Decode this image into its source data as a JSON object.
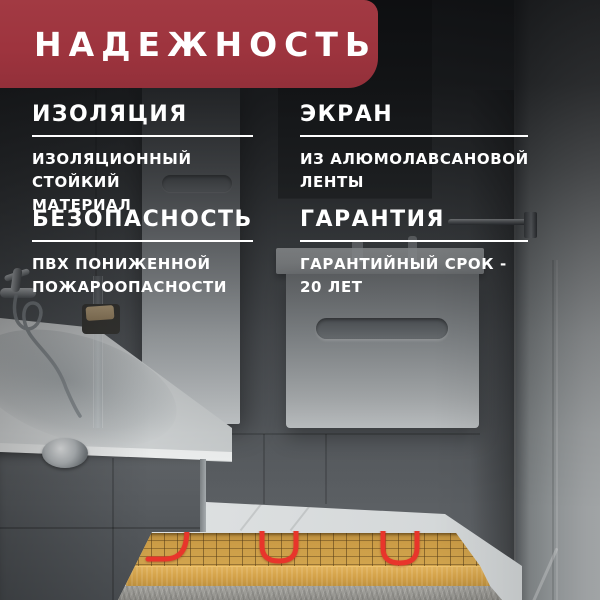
{
  "banner": {
    "title": "НАДЕЖНОСТЬ"
  },
  "features": [
    {
      "heading": "ИЗОЛЯЦИЯ",
      "description": "ИЗОЛЯЦИОННЫЙ СТОЙКИЙ\nМАТЕРИАЛ"
    },
    {
      "heading": "ЭКРАН",
      "description": "ИЗ АЛЮМОЛАВСАНОВОЙ\nЛЕНТЫ"
    },
    {
      "heading": "БЕЗОПАСНОСТЬ",
      "description": "ПВХ ПОНИЖЕННОЙ\nПОЖАРООПАСНОСТИ"
    },
    {
      "heading": "ГАРАНТИЯ",
      "description": "ГАРАНТИЙНЫЙ СРОК -\n20 ЛЕТ"
    }
  ],
  "colors": {
    "banner_background": "#9e343e",
    "text": "#ffffff",
    "heating_cable_red": "#e8352b",
    "heating_mat_tan": "#cb9c46",
    "screed_tan": "#d9a94f"
  }
}
